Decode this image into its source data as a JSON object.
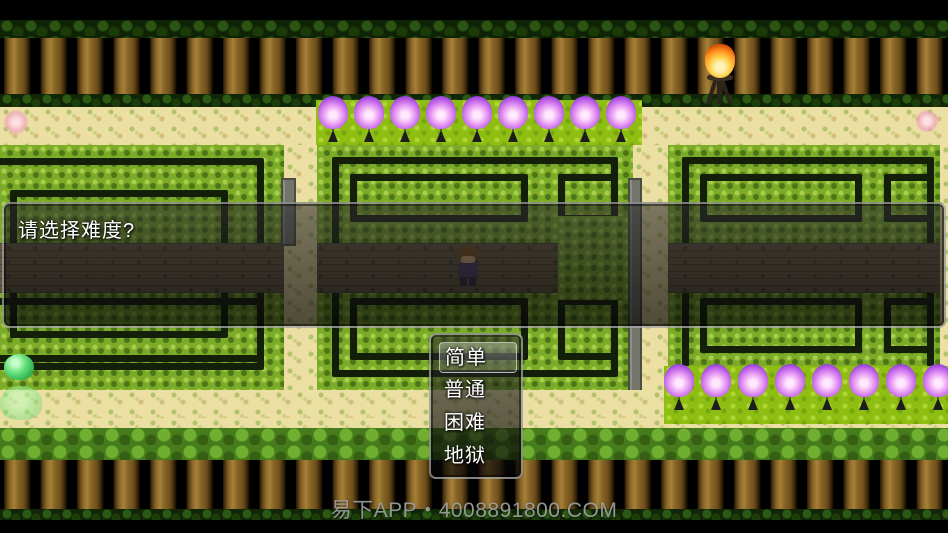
{
  "dialog": {
    "prompt": "请选择难度?"
  },
  "choice_menu": {
    "options": [
      {
        "label": "简单",
        "selected": true
      },
      {
        "label": "普通",
        "selected": false
      },
      {
        "label": "困难",
        "selected": false
      },
      {
        "label": "地狱",
        "selected": false
      }
    ]
  },
  "watermark": {
    "text": "易下APP・4008891800.COM"
  },
  "scene": {
    "purple_torch_flame_color": "#c76ceb",
    "bonfire_flame_color": "#ff8a1a",
    "hedge_color": "#7cab28",
    "sand_color": "#ecdfa4",
    "window_border_color": "#e8e8e8",
    "purple_torches_top_count": 9,
    "purple_torches_bottom_count": 8
  }
}
